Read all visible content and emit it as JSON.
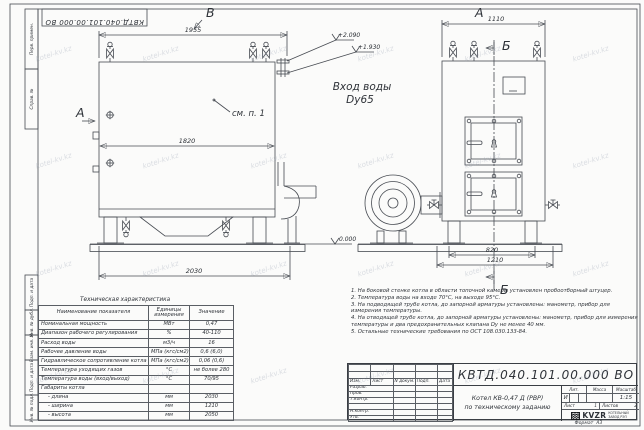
{
  "doc": {
    "number": "КВТД.040.101.00.000 ВО",
    "format_label": "Формат",
    "format_value": "А3"
  },
  "watermark": {
    "text": "kotel-kv.kz"
  },
  "frame": {
    "left_labels": [
      "Перв. примен.",
      "Справ. №",
      "Подп. и дата",
      "Инв. № дубл.",
      "Взам. инв. №",
      "Подп. и дата",
      "Инв. № подл."
    ]
  },
  "views": {
    "front": {
      "label_top": "В",
      "label_left": "А",
      "dim_top": "1955",
      "dim_mid": "1820",
      "dim_bottom": "2030",
      "callout": "см. п. 1",
      "elev_ground": "0.000"
    },
    "side": {
      "label_top": "А",
      "section_label": "Б",
      "dim_top": "1110",
      "dim_inner": "820",
      "dim_outer": "1210",
      "elev_upper": "+2.090",
      "elev_lower": "+1.930",
      "inlet_line1": "Вход воды",
      "inlet_line2": "Dy65"
    }
  },
  "table": {
    "title": "Техническая характеристика",
    "headers": [
      "Наименование показателя",
      "Единицы измерения",
      "Значение"
    ],
    "rows": [
      [
        "Номинальная мощность",
        "МВт",
        "0,47"
      ],
      [
        "Диапазон рабочего регулирования",
        "%",
        "40-110"
      ],
      [
        "Расход воды",
        "м3/ч",
        "16"
      ],
      [
        "Рабочее давление воды",
        "МПа (кгс/см2)",
        "0,6 (6,0)"
      ],
      [
        "Гидравлическое сопротивление котла",
        "МПа (кгс/см2)",
        "0,06 (0,6)"
      ],
      [
        "Температура уходящих газов",
        "°С",
        "не более 280"
      ],
      [
        "Температура воды (вход/выход)",
        "°С",
        "70/95"
      ],
      [
        "Габариты котла",
        "",
        ""
      ],
      [
        "- длина",
        "мм",
        "2030"
      ],
      [
        "- ширина",
        "мм",
        "1210"
      ],
      [
        "- высота",
        "мм",
        "2050"
      ]
    ]
  },
  "notes": [
    "1. На боковой стенке котла в области топочной камеры установлен пробоотборный штуцер.",
    "2. Температура воды на входе 70°С, на выходе 95°С.",
    "3. На подводящей трубе котла, до запорной арматуры установлены: манометр, прибор для измерения температуры.",
    "4. На отводящей трубе котла, до запорной арматуры установлены: манометр, прибор для измерения температуры и два предохранительных клапана Dу не менее 40 мм.",
    "5. Остальные технические требования по ОСТ 108.030.133-84."
  ],
  "titleblock": {
    "header_cols": [
      "Изм.",
      "Лист",
      "N докум.",
      "Подп.",
      "Дата"
    ],
    "row_labels": [
      "Разраб.",
      "Пров.",
      "Т.контр.",
      "",
      "Н.контр.",
      "Утв."
    ],
    "title_line1": "Котел КВ-0,47 Д (РВР)",
    "title_line2": "по техническому заданию",
    "lit_label": "Лит.",
    "lit_value": "И",
    "mass_label": "Масса",
    "scale_label": "Масштаб",
    "scale_value": "1:15",
    "sheet_label": "Лист",
    "sheet_value": "1",
    "sheets_label": "Листов",
    "sheets_value": "2",
    "company_name": "KVZR",
    "company_sub1": "КОТЕЛЬНЫЙ",
    "company_sub2": "ЗАВОД РЭП"
  }
}
